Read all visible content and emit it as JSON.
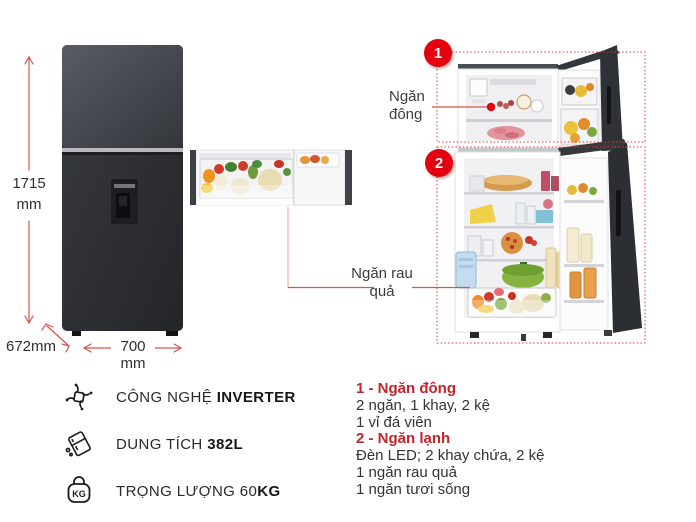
{
  "product": {
    "dimensions": {
      "height_value": "1715",
      "height_unit": "mm",
      "depth": "672mm",
      "width_value": "700",
      "width_unit": "mm"
    },
    "callouts": {
      "freezer_number": "1",
      "freezer_label_line1": "Ngăn",
      "freezer_label_line2": "đông",
      "fresh_number": "2",
      "veg_label_line1": "Ngăn rau",
      "veg_label_line2": "quả"
    }
  },
  "specs": [
    {
      "icon": "inverter-icon",
      "label": "CÔNG NGHỆ ",
      "value": "INVERTER"
    },
    {
      "icon": "capacity-icon",
      "label": "DUNG TÍCH ",
      "value": "382L"
    },
    {
      "icon": "weight-icon",
      "icon_text": "KG",
      "label": "TRỌNG LƯỢNG 60",
      "value": "KG"
    }
  ],
  "notes": [
    {
      "style": "heading",
      "text": "1 - Ngăn đông"
    },
    {
      "style": "normal",
      "text": "2 ngăn, 1 khay, 2 kệ"
    },
    {
      "style": "normal",
      "text": "1 vỉ đá viên"
    },
    {
      "style": "heading",
      "text": "2 - Ngăn lạnh"
    },
    {
      "style": "normal",
      "text": "Đèn LED; 2 khay chứa, 2 kệ"
    },
    {
      "style": "normal",
      "text": "1 ngăn rau quả"
    },
    {
      "style": "normal",
      "text": "1 ngăn tươi sống"
    }
  ],
  "colors": {
    "accent_red": "#e3000f",
    "heading_red": "#c4232b",
    "dimension_line": "#d9534f",
    "zone_dotted": "#e23b30",
    "fridge_dark": "#2e3136"
  }
}
